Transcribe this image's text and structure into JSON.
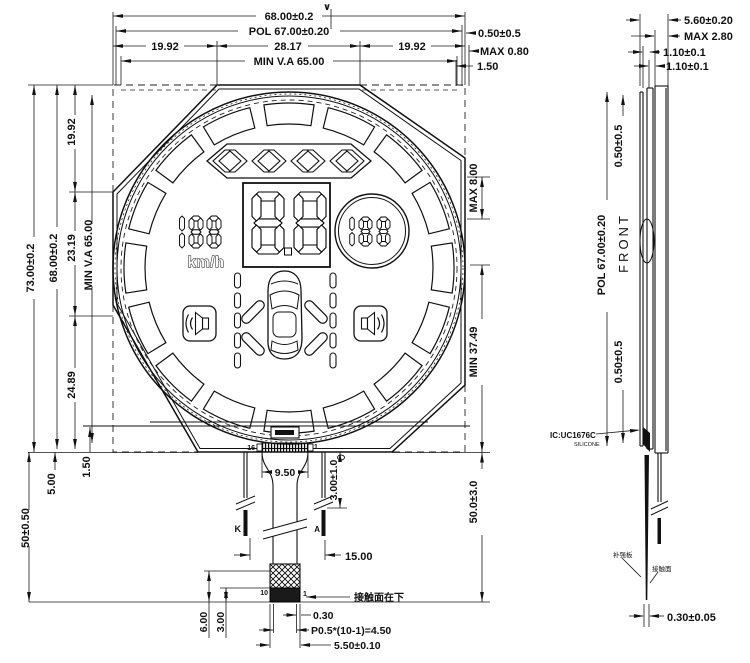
{
  "front_view": {
    "finish_mark": "∨",
    "dims_top": {
      "total": "68.00±0.2",
      "pol": "POL 67.00±0.20",
      "seg_left": "19.92",
      "seg_center": "28.17",
      "seg_right": "19.92",
      "view_area": "MIN V.A 65.00"
    },
    "dims_top_right": {
      "offset": "0.50±0.5",
      "max": "MAX 0.80",
      "inset": "1.50"
    },
    "dims_left": {
      "total": "73.00±0.2",
      "body": "68.00±0.2",
      "seg_top": "19.92",
      "seg_center": "23.19",
      "seg_bottom": "24.89",
      "view_area": "MIN V.A 65.00",
      "fpc_top": "5.00",
      "inset": "1.50",
      "tail_length": "50±0.50"
    },
    "dims_right": {
      "top_max": "MAX 8.00",
      "center_min": "MIN 37.49",
      "tail": "50.0±3.0"
    },
    "lcd": {
      "kmh_label": "km/h"
    },
    "connector": {
      "pin_left": "16",
      "pin_right": "1",
      "width": "9.50",
      "lead_drop": "3.00±1.0",
      "lead_left": "K",
      "lead_right": "A",
      "lead_span": "15.00",
      "tail_pin_left": "10",
      "tail_pin_right": "1",
      "note": "接触面在下",
      "edge": "0.30",
      "pitch": "P0.5*(10-1)=4.50",
      "tail_width": "5.50±0.10",
      "stiffener_h": "6.00",
      "contact_h": "3.00"
    }
  },
  "side_view": {
    "dims_top": {
      "total": "5.60±0.20",
      "module_max": "MAX 2.80",
      "glass_front": "1.10±0.1",
      "glass_rear": "1.10±0.1"
    },
    "pol": "POL 67.00±0.20",
    "front_label": "FRONT",
    "pol_offset_top": "0.50±0.5",
    "pol_offset_bottom": "0.50±0.5",
    "ic_label": "IC:UC1676C",
    "silicone_label": "SILICONE",
    "stiffener_label": "补强板",
    "contact_label": "接触面",
    "tail_width": "0.30±0.05"
  }
}
